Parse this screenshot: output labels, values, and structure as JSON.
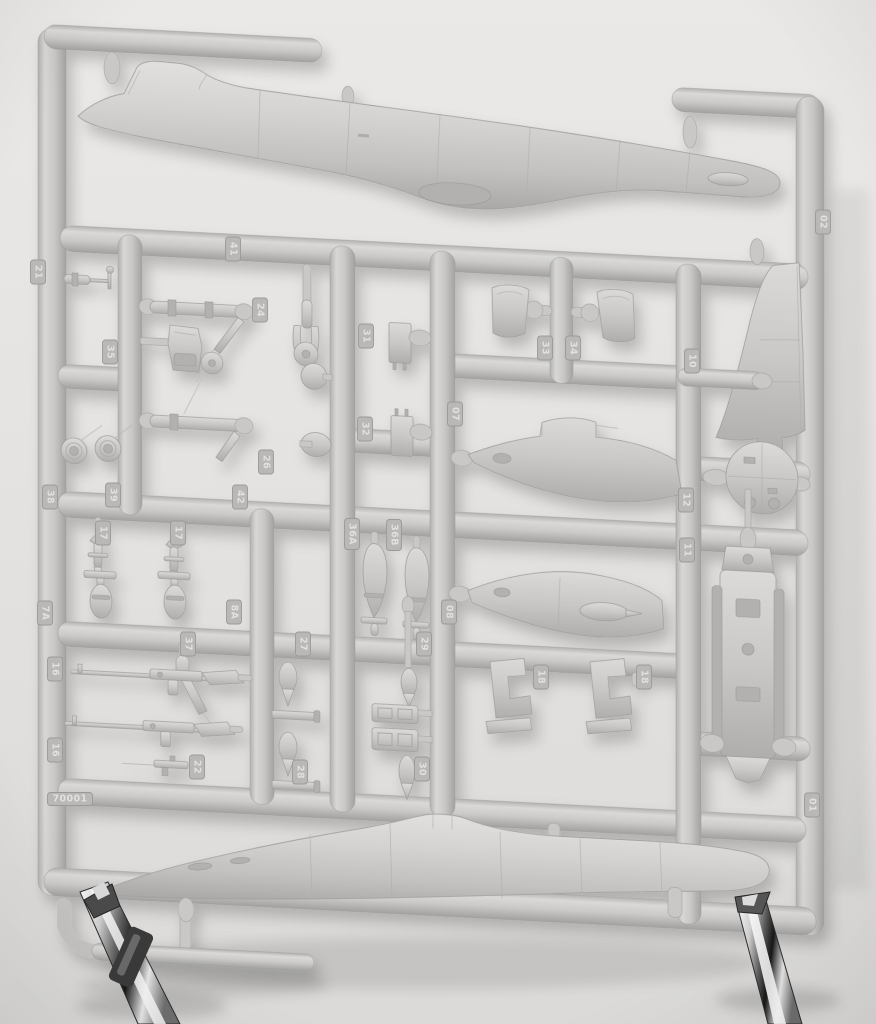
{
  "scene": {
    "type": "photograph",
    "subject": "injection-molded model kit sprue with aircraft parts",
    "sprue_color": "#c6c5c3",
    "background_color": "#e6e4e2",
    "chrome_parts_present": true
  },
  "sprue": {
    "mold_number": "70001",
    "part_tags": [
      {
        "label": "21",
        "x": 38,
        "y": 272,
        "rot": 90
      },
      {
        "label": "35",
        "x": 110,
        "y": 352,
        "rot": 90
      },
      {
        "label": "38",
        "x": 50,
        "y": 497,
        "rot": 90
      },
      {
        "label": "39",
        "x": 113,
        "y": 495,
        "rot": 90
      },
      {
        "label": "41",
        "x": 233,
        "y": 249,
        "rot": 90
      },
      {
        "label": "24",
        "x": 260,
        "y": 310,
        "rot": 90
      },
      {
        "label": "26",
        "x": 266,
        "y": 462,
        "rot": 90
      },
      {
        "label": "42",
        "x": 240,
        "y": 497,
        "rot": 90
      },
      {
        "label": "31",
        "x": 366,
        "y": 336,
        "rot": 90
      },
      {
        "label": "32",
        "x": 365,
        "y": 429,
        "rot": 90
      },
      {
        "label": "07",
        "x": 455,
        "y": 414,
        "rot": 90
      },
      {
        "label": "33",
        "x": 545,
        "y": 348,
        "rot": 90
      },
      {
        "label": "34",
        "x": 573,
        "y": 348,
        "rot": 90
      },
      {
        "label": "10",
        "x": 692,
        "y": 361,
        "rot": 90
      },
      {
        "label": "02",
        "x": 823,
        "y": 222,
        "rot": 90
      },
      {
        "label": "12",
        "x": 686,
        "y": 500,
        "rot": 90
      },
      {
        "label": "11",
        "x": 687,
        "y": 550,
        "rot": 90
      },
      {
        "label": "17",
        "x": 103,
        "y": 533,
        "rot": 90
      },
      {
        "label": "17",
        "x": 178,
        "y": 533,
        "rot": 90
      },
      {
        "label": "7A",
        "x": 45,
        "y": 613,
        "rot": 90
      },
      {
        "label": "8A",
        "x": 234,
        "y": 612,
        "rot": 90
      },
      {
        "label": "36A",
        "x": 352,
        "y": 534,
        "rot": 90
      },
      {
        "label": "36B",
        "x": 394,
        "y": 535,
        "rot": 90
      },
      {
        "label": "37",
        "x": 188,
        "y": 644,
        "rot": 90
      },
      {
        "label": "27",
        "x": 303,
        "y": 644,
        "rot": 90
      },
      {
        "label": "29",
        "x": 424,
        "y": 644,
        "rot": 90
      },
      {
        "label": "08",
        "x": 449,
        "y": 612,
        "rot": 90
      },
      {
        "label": "18",
        "x": 541,
        "y": 677,
        "rot": 90
      },
      {
        "label": "18",
        "x": 644,
        "y": 677,
        "rot": 90
      },
      {
        "label": "16",
        "x": 55,
        "y": 669,
        "rot": 90
      },
      {
        "label": "16",
        "x": 55,
        "y": 750,
        "rot": 90
      },
      {
        "label": "22",
        "x": 197,
        "y": 767,
        "rot": 90
      },
      {
        "label": "28",
        "x": 300,
        "y": 772,
        "rot": 90
      },
      {
        "label": "30",
        "x": 422,
        "y": 769,
        "rot": 90
      },
      {
        "label": "01",
        "x": 812,
        "y": 805,
        "rot": 90
      },
      {
        "label": "70001",
        "x": 70,
        "y": 799,
        "rot": 0
      }
    ],
    "parts": [
      {
        "part_no": "01",
        "name": "lower-fuselage-half"
      },
      {
        "part_no": "02",
        "name": "upper-fuselage-half"
      },
      {
        "part_no": "07",
        "name": "wing-root-fairing"
      },
      {
        "part_no": "08",
        "name": "wing-root-fairing-with-intake"
      },
      {
        "part_no": "10",
        "name": "vertical-tail-fin"
      },
      {
        "part_no": "11",
        "name": "cockpit-tub"
      },
      {
        "part_no": "12",
        "name": "bulkhead-disc"
      },
      {
        "part_no": "16",
        "name": "machine-gun"
      },
      {
        "part_no": "17",
        "name": "rocket"
      },
      {
        "part_no": "18",
        "name": "seat-bracket"
      },
      {
        "part_no": "21",
        "name": "pitot-probe"
      },
      {
        "part_no": "22",
        "name": "gun-barrel"
      },
      {
        "part_no": "24",
        "name": "nose-wheel-fork"
      },
      {
        "part_no": "26",
        "name": "gear-strut"
      },
      {
        "part_no": "27",
        "name": "bomb"
      },
      {
        "part_no": "28",
        "name": "bomb"
      },
      {
        "part_no": "29",
        "name": "small-drop-tank"
      },
      {
        "part_no": "30",
        "name": "small-drop-tank"
      },
      {
        "part_no": "31",
        "name": "equipment-box"
      },
      {
        "part_no": "32",
        "name": "equipment-box"
      },
      {
        "part_no": "33",
        "name": "intake-lip"
      },
      {
        "part_no": "34",
        "name": "intake-lip"
      },
      {
        "part_no": "35",
        "name": "pilot-seat"
      },
      {
        "part_no": "36A",
        "name": "drop-tank"
      },
      {
        "part_no": "36B",
        "name": "drop-tank"
      },
      {
        "part_no": "37",
        "name": "aerial-blade"
      },
      {
        "part_no": "38",
        "name": "wheel"
      },
      {
        "part_no": "39",
        "name": "wheel"
      },
      {
        "part_no": "41",
        "name": "gear-strut-upper"
      },
      {
        "part_no": "42",
        "name": "gear-strut-lower"
      },
      {
        "part_no": "7A",
        "name": "small-bomb"
      },
      {
        "part_no": "8A",
        "name": "small-bomb"
      }
    ]
  }
}
